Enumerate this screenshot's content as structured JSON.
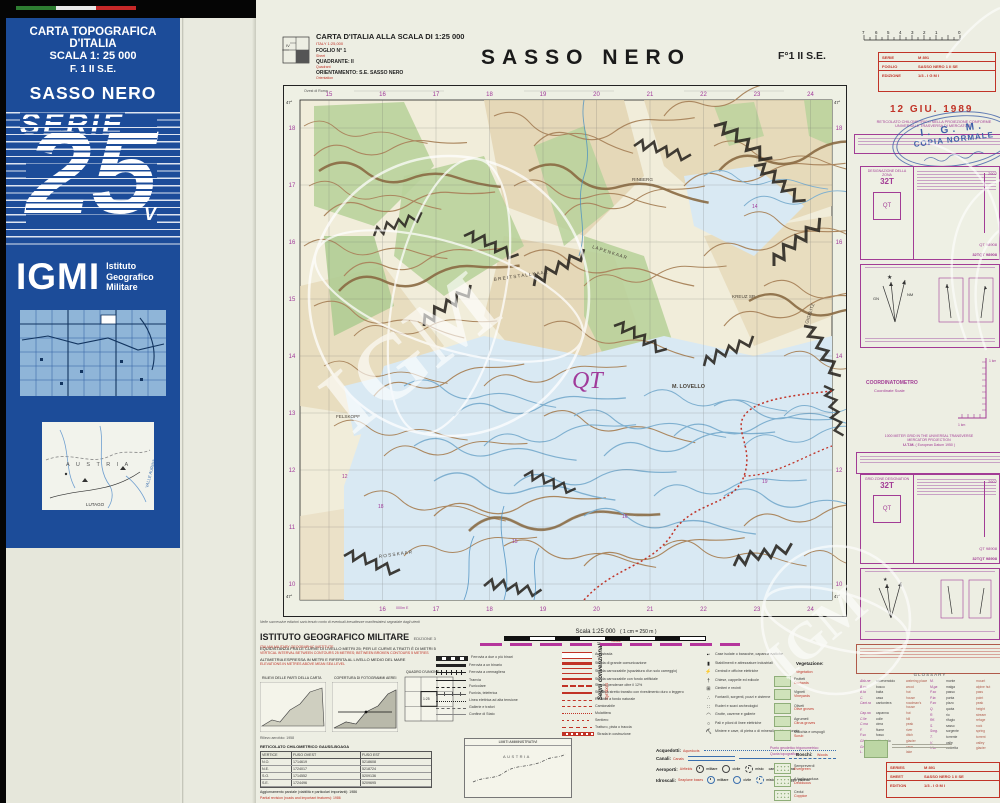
{
  "cover": {
    "title1": "CARTA TOPOGRAFICA D'ITALIA",
    "title2": "SCALA 1: 25 000",
    "title3": "F. 1 II S.E.",
    "name": "SASSO NERO",
    "serie": "SERIE",
    "number": "25",
    "v": "V",
    "logo": "IGMI",
    "inst1": "Istituto",
    "inst2": "Geografico",
    "inst3": "Militare",
    "inset": {
      "austria": "A U S T R I A",
      "lutago": "LUTAGO",
      "valle": "VALLE AURINA"
    }
  },
  "header": {
    "carta": "CARTA D'ITALIA ALLA SCALA DI 1:25 000",
    "italy": "ITALY 1:25,000",
    "foglio": "FOGLIO N° 1",
    "sheet": "Sheet",
    "quadrante": "QUADRANTE: II",
    "quadrant": "Quadrant",
    "orientamento": "ORIENTAMENTO: S.E.  SASSO NERO",
    "orientation": "Orientation",
    "title": "SASSO NERO",
    "code": "F°1 II S.E.",
    "ruler": [
      "7",
      "6",
      "5",
      "4",
      "3",
      "2",
      "1",
      "0"
    ]
  },
  "stamps": {
    "serie_it": {
      "k1": "SERIE",
      "v1": "M 891",
      "k2": "FOGLIO",
      "v2": "SASSO NERO 1 II SE",
      "k3": "EDIZIONE",
      "v3": "1/3 - I G M I"
    },
    "date": "12 GIU. 1989",
    "retic1": "RETICOLATO CHILOMETRICO NELLA PROIEZIONE CONFORME",
    "retic2": "UNIVERSALE TRASVERSA DI MERCATORE",
    "oval1": "I. G. M.",
    "oval2": "COPIA  NORMALE",
    "series_en": {
      "k1": "SERIES",
      "v1": "M 891",
      "k2": "SHEET",
      "v2": "SASSO NERO 1 II SE",
      "k3": "EDITION",
      "v3": "1/3 - I G M I"
    }
  },
  "margin": {
    "zona_it_title": "DESIGNAZIONE DELLA ZONA",
    "zona_code": "32T",
    "sample": "QT",
    "point_value": "2602",
    "ref1": "QT 98908",
    "ref2": "32TQT 98908",
    "coordinatometro": "COORDINATOMETRO",
    "coordscale": "Coordinate Scale",
    "utm1": "1000 METER GRID IN THE UNIVERSAL TRANSVERSE",
    "utm2": "MERCATOR PROJECTION",
    "utm3": "U.T.M.",
    "utm4": "( European Datum 1950 )",
    "zona_en_title": "GRID ZONE DESIGNATION",
    "glossary_title": "GLOSSARY"
  },
  "map": {
    "grid_top": [
      "15",
      "16",
      "17",
      "18",
      "19",
      "20",
      "21",
      "22",
      "23",
      "24"
    ],
    "grid_left": [
      "18",
      "17",
      "16",
      "15",
      "14",
      "13",
      "12",
      "11",
      "10"
    ],
    "grid_bottom": [
      "16",
      "17",
      "18",
      "19",
      "20",
      "21",
      "22",
      "23",
      "24"
    ],
    "bottom_suffix": "000m E",
    "corner": "47°",
    "ovest": "Ovest di Roma",
    "labels": {
      "breitstall": "B R E I T S T A L L   K A A R",
      "lapen": "L A P E N   K A A R",
      "rinberg": "RINBERG",
      "gigelitz": "GIGELITZ",
      "kreuz": "KREUZ SP.",
      "lovello": "M. LOVELLO",
      "ross": "R O S S   K A A R",
      "felskopf": "FELSKOPF",
      "qt": "QT"
    },
    "refs": [
      "14",
      "12",
      "18",
      "15",
      "16",
      "19"
    ]
  },
  "legend": {
    "note_top": "Nelle successive edizioni sarà tenuto conto di eventuali inesattezze manifestatesi segnalate dagli utenti",
    "igm": "ISTITUTO GEOGRAFICO MILITARE",
    "edizione": "EDIZIONE 3",
    "igm_en": "ITALIAN MILITARY GEOGRAPHIC INSTITUTE",
    "equi_it": "EQUIDISTANZA FRA LE CURVE DI LIVELLO METRI 25;  PER LE CURVE A TRATTI È DI METRI 5",
    "equi_en": "VERTICAL INTERVAL BETWEEN CONTOURS 25 METRES; BETWEEN BROKEN CONTOURS 5 METRES",
    "alti_it": "ALTIMETRIA ESPRESSA IN METRI E RIFERITA AL LIVELLO MEDIO DEL MARE",
    "alti_en": "ELEVATIONS IN METRES ABOVE MEAN SEA LEVEL",
    "diag1": "RILIEVI DELLE PARTI DELLA CARTA",
    "diag1_note": "Rilievo aerofoto: 1958",
    "diag2": "COPERTURA DI FOTOGRAMMI AEREI",
    "diag3": "QUADRO D'UNIONE",
    "gauss": "RETICOLATO CHILOMETRICO GAUSS-BOAGA",
    "gauss_v": "VERTICE",
    "gauss_w": "FUSO OVEST",
    "gauss_e2": "FUSO EST",
    "gauss_rows": [
      {
        "v": "N.O.",
        "e": "1714619",
        "n": "5218608"
      },
      {
        "v": "N.E.",
        "e": "1724017",
        "n": "5218724"
      },
      {
        "v": "S.O.",
        "e": "1714552",
        "n": "5209136"
      },
      {
        "v": "S.E.",
        "e": "1724496",
        "n": "5209695"
      }
    ],
    "limiti": "LIMITI AMMINISTRATIVI",
    "limiti_austria": "AUSTRIA",
    "agg_it": "Aggiornamento parziale (viabilità e particolari importanti): 1986",
    "agg_en": "Partial revision (roads and important features): 1986",
    "scala": "Scala 1:25 000",
    "scala2": "( 1 cm = 250 m )",
    "scale_en": "Scale",
    "segni": "Segni convenzionali",
    "symbols": "Symbols",
    "colA": [
      {
        "sym": "sA1",
        "it": "Ferrovia a due o più binari"
      },
      {
        "sym": "sA2",
        "it": "Ferrovia a un binario"
      },
      {
        "sym": "sA3",
        "it": "Ferrovia a cremagliera"
      },
      {
        "sym": "sA4",
        "it": "Tranvia"
      },
      {
        "sym": "sA5",
        "it": "Funicolare"
      },
      {
        "sym": "sA7",
        "it": "Funivia, teleferica"
      },
      {
        "sym": "sA6",
        "it": "Linea elettrica ad alta tensione"
      },
      {
        "sym": "sA8",
        "it": "Gallerie e trafori"
      },
      {
        "sym": "sA9",
        "it": "Confine di Stato"
      }
    ],
    "colB": [
      {
        "sym": "sB1",
        "it": "Autostrada"
      },
      {
        "sym": "sB2",
        "it": "Strada di grande comunicazione"
      },
      {
        "sym": "sB3",
        "it": "Strada carrozzabile (spaziatura d'un solo carreggio)"
      },
      {
        "sym": "sB4",
        "it": "Strada carrozzabile con fondo artificiale"
      },
      {
        "sym": "sB5",
        "it": "Strada, pendenze oltre il 12%"
      },
      {
        "sym": "sB6",
        "it": "Strada a stretto transito con rivestimento duro o leggero"
      },
      {
        "sym": "sB7",
        "it": "Rotabile a fondo naturale"
      },
      {
        "sym": "sB8",
        "it": "Camionabile"
      },
      {
        "sym": "sB9",
        "it": "Mulattiera"
      },
      {
        "sym": "sB11",
        "it": "Sentiero"
      },
      {
        "sym": "sB10",
        "it": "Tratturo, pista o traccia"
      },
      {
        "sym": "sB12",
        "it": "Strada in costruzione"
      }
    ],
    "colC": [
      {
        "g": "▪▫",
        "it": "Case isolate o baracche, capanne rustiche"
      },
      {
        "g": "▮",
        "it": "Stabilimenti e attrezzature industriali"
      },
      {
        "g": "⚡",
        "it": "Centrali e officine elettriche"
      },
      {
        "g": "†",
        "it": "Chiese, cappelle ed edicole"
      },
      {
        "g": "⊞",
        "it": "Cimiteri e recinti"
      },
      {
        "g": "∴",
        "it": "Fontanili, sorgenti, pozzi e cisterne"
      },
      {
        "g": "∷",
        "it": "Ruderi e scavi archeologici"
      },
      {
        "g": "◠",
        "it": "Grotte, caverne e gallerie"
      },
      {
        "g": "○",
        "it": "Pali e piloni di linee elettriche"
      },
      {
        "g": "⛏",
        "it": "Miniere e cave, di pietra o di minerali, e abbandonate"
      }
    ],
    "acquedotti": "Acquedotti:",
    "aqueducts": "Aqueducts",
    "canali": "Canali:",
    "canals": "Canals",
    "aeroporti": "Aeroporti:",
    "airfields": "Airfields",
    "idroscali": "Idroscali:",
    "seaplane": "Seaplane bases",
    "aero": [
      {
        "l": "militare"
      },
      {
        "l": "civile"
      },
      {
        "l": "misto"
      },
      {
        "l": "campo di fortuna"
      }
    ],
    "idro": [
      {
        "l": "militare"
      },
      {
        "l": "civile"
      },
      {
        "l": "misto"
      },
      {
        "l": "ancoraggio protetto"
      }
    ],
    "punto_geo": "Punto geodetico trigonometrico",
    "quota_topo": "Quota topografica",
    "vegetazione": "Vegetazione:",
    "vegetation": "Vegetation",
    "veg": [
      {
        "it": "Frutteti",
        "en": "Orchards"
      },
      {
        "it": "Vigneti",
        "en": "Vineyards"
      },
      {
        "it": "Oliveti",
        "en": "Olive groves"
      },
      {
        "it": "Agrumeti",
        "en": "Citrus groves"
      },
      {
        "it": "Macchia e cespugli",
        "en": "Scrub"
      }
    ],
    "boschi": "Boschi:",
    "woods": "Woods",
    "boschi_items": [
      {
        "it": "Sempreverdi",
        "en": "Evergreen"
      },
      {
        "it": "A foglia caduca",
        "en": "Deciduous"
      },
      {
        "it": "Cedui",
        "en": "Coppice"
      }
    ]
  },
  "glossary1": [
    {
      "a": "Abb.ne",
      "it": "abbeveratoio",
      "en": "watering place"
    },
    {
      "a": "B.co",
      "it": "bosco",
      "en": "wood"
    },
    {
      "a": "B.ta",
      "it": "baita",
      "en": "hut"
    },
    {
      "a": "C.",
      "it": "casa",
      "en": "house"
    },
    {
      "a": "Cant.ra",
      "it": "cantoniera",
      "en": "roadman's house"
    },
    {
      "a": "Cap.na",
      "it": "capanna",
      "en": "hut"
    },
    {
      "a": "C.lle",
      "it": "colle",
      "en": "hill"
    },
    {
      "a": "C.ma",
      "it": "cima",
      "en": "peak"
    },
    {
      "a": "F.",
      "it": "fiume",
      "en": "river"
    },
    {
      "a": "F.so",
      "it": "fosso",
      "en": "ditch"
    },
    {
      "a": "Gh.io",
      "it": "ghiacciaio",
      "en": "glacier"
    },
    {
      "a": "Gr.ta",
      "it": "grotta",
      "en": "cave"
    },
    {
      "a": "L.",
      "it": "lago",
      "en": "lake"
    }
  ],
  "glossary2": [
    {
      "a": "M.",
      "it": "monte",
      "en": "mount"
    },
    {
      "a": "M.ga",
      "it": "malga",
      "en": "alpine hut"
    },
    {
      "a": "P.so",
      "it": "passo",
      "en": "pass"
    },
    {
      "a": "P.ta",
      "it": "punta",
      "en": "point"
    },
    {
      "a": "P.zo",
      "it": "pizzo",
      "en": "peak"
    },
    {
      "a": "Q.",
      "it": "quota",
      "en": "height"
    },
    {
      "a": "R.",
      "it": "rio",
      "en": "stream"
    },
    {
      "a": "Rif.",
      "it": "rifugio",
      "en": "refuge"
    },
    {
      "a": "S.",
      "it": "sasso",
      "en": "rock"
    },
    {
      "a": "Sorg.",
      "it": "sorgente",
      "en": "spring"
    },
    {
      "a": "T.",
      "it": "torrente",
      "en": "torrent"
    },
    {
      "a": "V.",
      "it": "valle",
      "en": "valley"
    },
    {
      "a": "V.ta",
      "it": "vedretta",
      "en": "glacier"
    }
  ]
}
